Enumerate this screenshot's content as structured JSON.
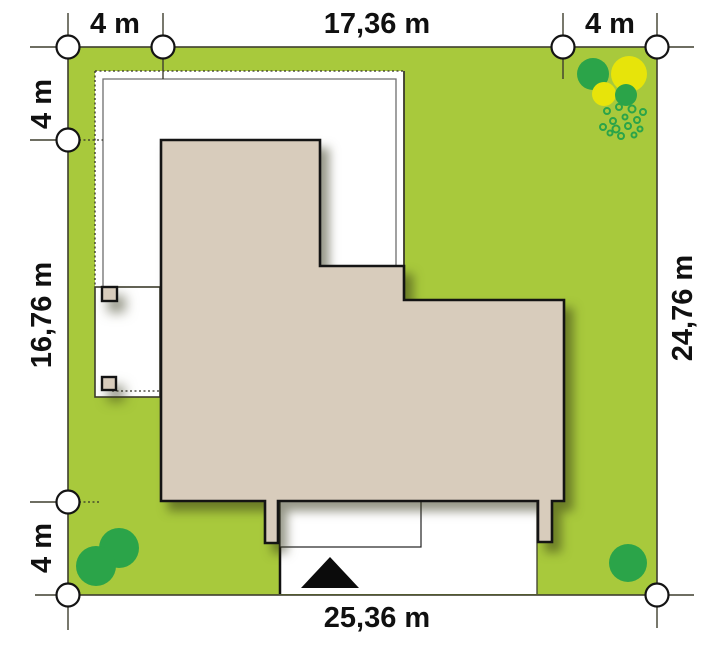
{
  "plan": {
    "type": "house-site-plan",
    "dimensions": {
      "top_left": "4 m",
      "top_center": "17,36 m",
      "top_right": "4 m",
      "left_top": "4 m",
      "left_center": "16,76 m",
      "left_bottom": "4 m",
      "right_side": "24,76 m",
      "bottom": "25,36 m"
    }
  },
  "colors": {
    "grass": "#a8c93c",
    "house": "#d8ccbc",
    "house_outline": "#141414",
    "paving": "#ffffff",
    "tree_green": "#2ba449",
    "tree_yellow": "#e7e40a",
    "boundary_line": "#3e3e2e",
    "marker_fill": "#ffffff",
    "text": "#111111"
  }
}
